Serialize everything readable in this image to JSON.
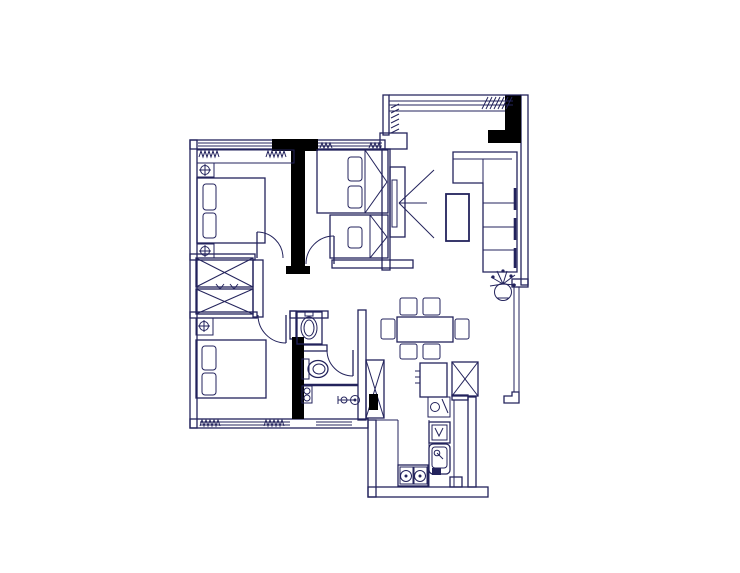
{
  "colors": {
    "background": "#ffffff",
    "line": "#23235c",
    "wall": "#000000"
  },
  "drawing": {
    "type": "apartment-floor-plan",
    "rooms": [
      {
        "name": "master-bedroom",
        "items": [
          "window-with-curtains",
          "headboard-shelf",
          "nightstand-lamp",
          "double-bed",
          "pillows",
          "swing-door"
        ]
      },
      {
        "name": "second-bedroom",
        "items": [
          "window-with-curtains",
          "upper-bed",
          "lower-bed",
          "pillows",
          "swing-door"
        ]
      },
      {
        "name": "living-room",
        "items": [
          "bay-window",
          "corner-column",
          "tv-unit",
          "l-shaped-sofa",
          "coffee-table",
          "potted-plant",
          "side-window"
        ]
      },
      {
        "name": "dining-area",
        "items": [
          "dining-table",
          "six-chairs",
          "service-counter",
          "refrigerator"
        ]
      },
      {
        "name": "hallway",
        "items": [
          "storage-cabinet-crossed",
          "storage-cabinet-crossed"
        ]
      },
      {
        "name": "third-bedroom",
        "items": [
          "window-with-curtains",
          "nightstand-lamp",
          "double-bed",
          "pillows",
          "swing-door"
        ]
      },
      {
        "name": "bathroom",
        "items": [
          "washbasin",
          "toilet",
          "water-heater",
          "shower-head",
          "swing-door",
          "window"
        ]
      },
      {
        "name": "kitchen",
        "items": [
          "counter",
          "two-burner-stove",
          "sink",
          "hob-unit",
          "flue-duct"
        ]
      }
    ]
  }
}
